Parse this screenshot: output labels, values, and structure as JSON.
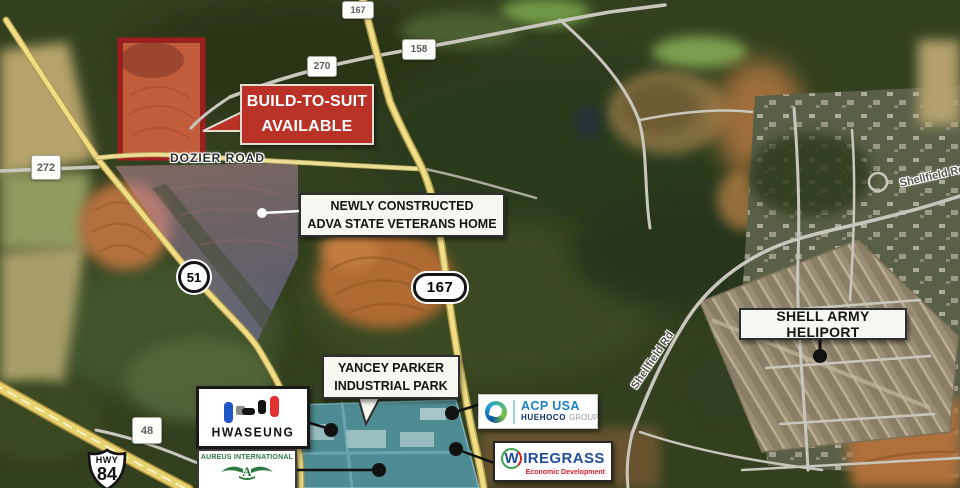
{
  "map": {
    "shields": {
      "hwy167_top": "167",
      "road158": "158",
      "road270": "270",
      "road272": "272",
      "hwy51": "51",
      "hwy167_mid": "167",
      "road48": "48",
      "us84_prefix": "HWY",
      "us84_number": "84"
    },
    "road_labels": {
      "dozier": "DOZIER ROAD",
      "shellfield_center": "Shellfield Rd",
      "shellfield_right": "Shellfield Rd"
    },
    "callouts": {
      "build_to_suit": {
        "line1": "BUILD-TO-SUIT",
        "line2": "AVAILABLE"
      },
      "veterans_home": {
        "line1": "NEWLY CONSTRUCTED",
        "line2": "ADVA STATE VETERANS HOME"
      },
      "heliport": {
        "label": "SHELL ARMY HELIPORT"
      },
      "industrial_park": {
        "line1": "YANCEY PARKER",
        "line2": "INDUSTRIAL PARK"
      }
    },
    "tenants": {
      "hwaseung": {
        "name": "HWASEUNG"
      },
      "aureus": {
        "name": "AUREUS INTERNATIONAL",
        "monogram": "A"
      },
      "acp": {
        "name": "ACP USA",
        "group_bold": "HUEHOCO",
        "group_rest": "GROUP"
      },
      "wiregrass": {
        "first_letter": "W",
        "name_rest": "IREGRASS",
        "tagline": "Economic Development"
      }
    },
    "colors": {
      "accent_red": "#b93127",
      "parcel_red_border": "#9f1d1f",
      "overlay_purple": "#9b86b9",
      "overlay_blue": "#60bee0",
      "road_yellow": "#f0dd84",
      "hwaseung_blue": "#2257c9",
      "hwaseung_red": "#e23230",
      "acp_blue": "#1b80c4",
      "huehoco_navy": "#0b2e6b",
      "wiregrass_blue": "#204e9b",
      "wiregrass_red": "#d2232a",
      "aureus_green": "#2f7a43"
    }
  }
}
